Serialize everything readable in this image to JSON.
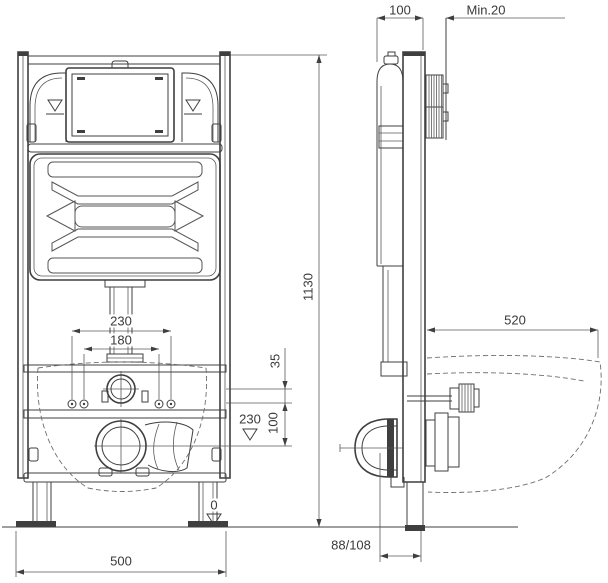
{
  "drawing": {
    "kind": "wc-installation-frame-technical-drawing",
    "line_color": "#3f3f3f",
    "background_color": "#ffffff",
    "views": {
      "front": "front-elevation-of-installation-frame",
      "side": "side-profile-with-bowl-outline"
    }
  },
  "dimensions": {
    "frame_depth_top": "100",
    "wall_clearance_min": "Min.20",
    "frame_height": "1130",
    "bowl_depth": "520",
    "fixing_spacing_outer": "230",
    "fixing_spacing_inner": "180",
    "flush_center_offset": "35",
    "fixing_to_drain": "100",
    "drain_height_level": "230",
    "floor_level": "0",
    "frame_width": "500",
    "outlet_offset": "88/108"
  }
}
